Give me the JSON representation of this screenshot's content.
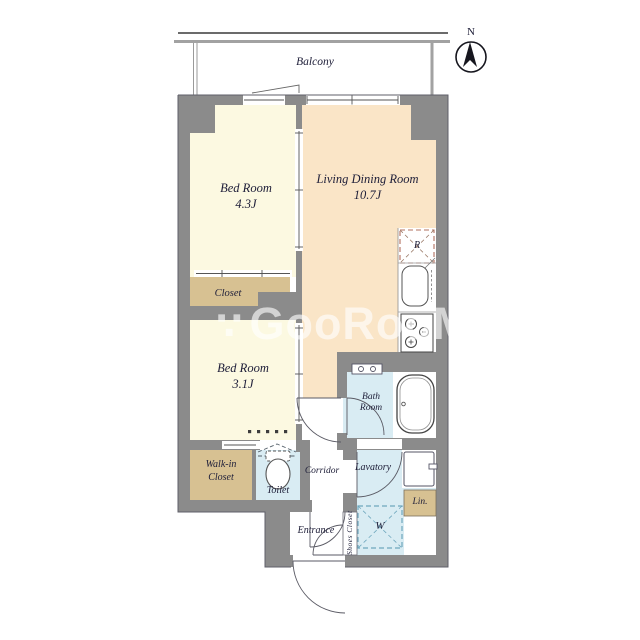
{
  "balcony": {
    "label": "Balcony"
  },
  "compass": {
    "label": "N"
  },
  "rooms": {
    "bedroom1": {
      "name": "Bed Room",
      "size": "4.3J"
    },
    "ldk": {
      "name": "Living Dining Room",
      "size": "10.7J"
    },
    "closet1": {
      "label": "Closet"
    },
    "bedroom2": {
      "name": "Bed Room",
      "size": "3.1J"
    },
    "walkin": {
      "line1": "Walk-in",
      "line2": "Closet"
    },
    "toilet": {
      "label": "Toilet"
    },
    "corridor": {
      "label": "Corridor"
    },
    "bath": {
      "line1": "Bath",
      "line2": "Room"
    },
    "lavatory": {
      "label": "Lavatory"
    },
    "entrance": {
      "label": "Entrance"
    },
    "shoes": {
      "label": "Shoes Closet"
    },
    "linen": {
      "label": "Lin."
    }
  },
  "fixtures": {
    "washer": "W",
    "fridge": "R"
  },
  "watermark": {
    "icon": "∵",
    "text": "GooRooM"
  },
  "colors": {
    "room_cream": "#fcf9e1",
    "room_peach": "#fae5c7",
    "closet_tan": "#d7c192",
    "wet_blue": "#d9ecf3",
    "wall_gray": "#8b8b8b",
    "label_ink": "#20203a"
  }
}
